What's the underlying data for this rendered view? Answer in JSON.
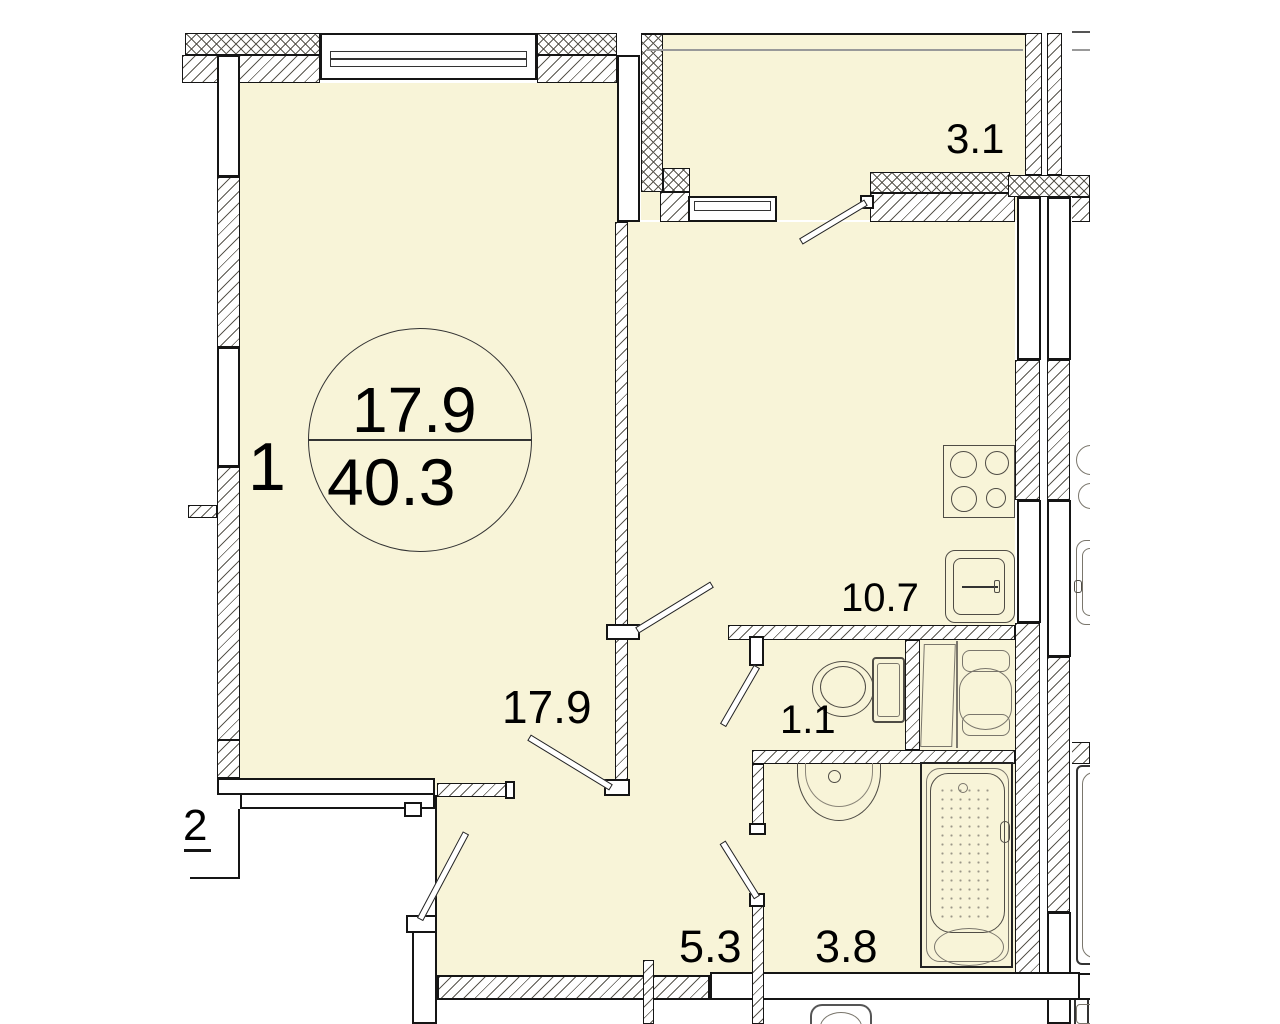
{
  "plan": {
    "unit": {
      "rooms_label": "1",
      "living_area": "17.9",
      "total_area": "40.3"
    },
    "adjacent_unit_label": "2",
    "rooms": [
      {
        "id": "living-room",
        "area": "17.9"
      },
      {
        "id": "kitchen",
        "area": "10.7"
      },
      {
        "id": "hallway",
        "area": "5.3"
      },
      {
        "id": "bathroom",
        "area": "3.8"
      },
      {
        "id": "wc",
        "area": "1.1"
      },
      {
        "id": "balcony",
        "area": "3.1"
      }
    ],
    "fixtures": [
      "stove",
      "kitchen-sink",
      "toilet",
      "washing-machine",
      "washbasin",
      "bathtub"
    ],
    "colors": {
      "room_fill": "#F8F4D8",
      "wall_line": "#151515",
      "hatch_line": "#5a574f",
      "fixture_line": "#4f4c45"
    }
  }
}
